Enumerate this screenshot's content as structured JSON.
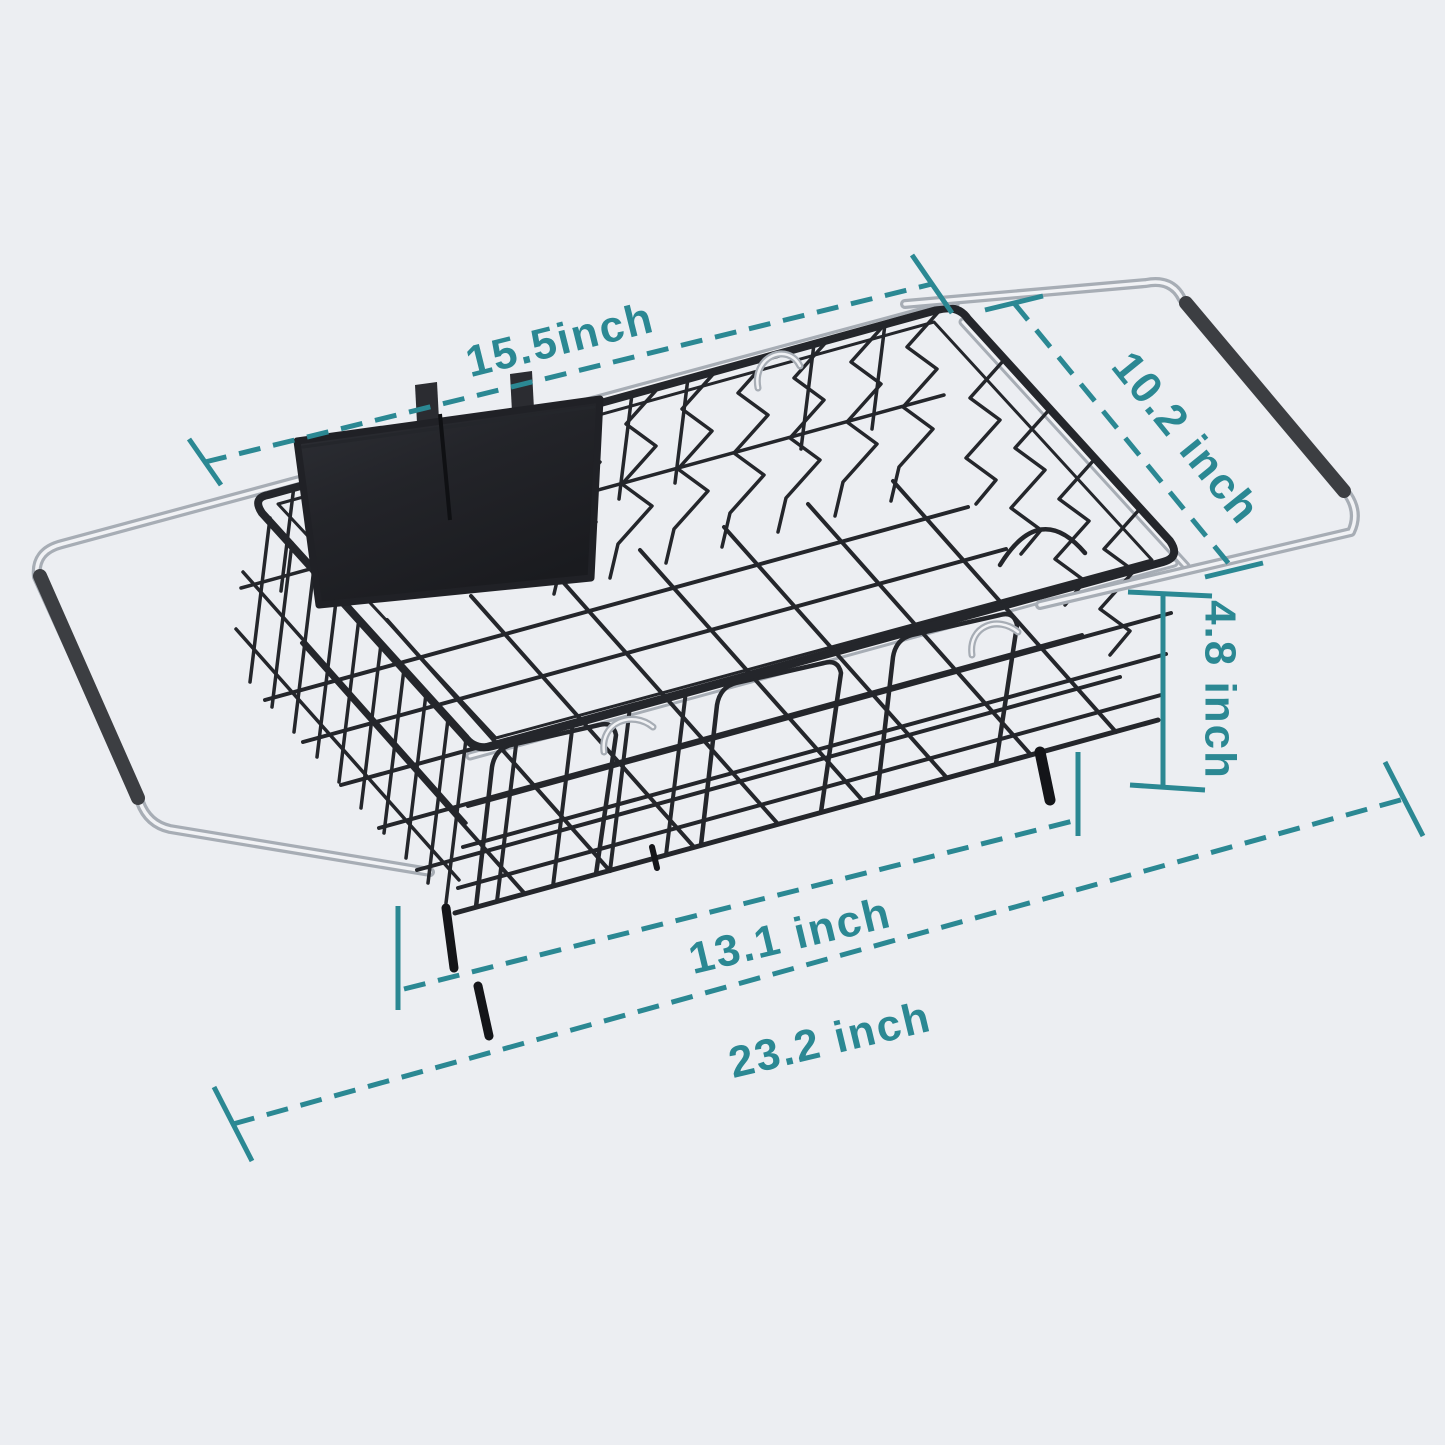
{
  "colors": {
    "background": "#eceef2",
    "accent": "#2b8893",
    "wire": "#24262b",
    "wire_dark": "#141519",
    "chrome": "#a7adb5",
    "chrome_light": "#f1f2f5",
    "grip": "#3c3e42",
    "cup": "#232429"
  },
  "annotations": {
    "top_width": {
      "label": "15.5inch"
    },
    "depth": {
      "label": "10.2 inch"
    },
    "height": {
      "label": "4.8 inch"
    },
    "basket_length": {
      "label": "13.1 inch"
    },
    "overall_length": {
      "label": "23.2 inch"
    }
  }
}
